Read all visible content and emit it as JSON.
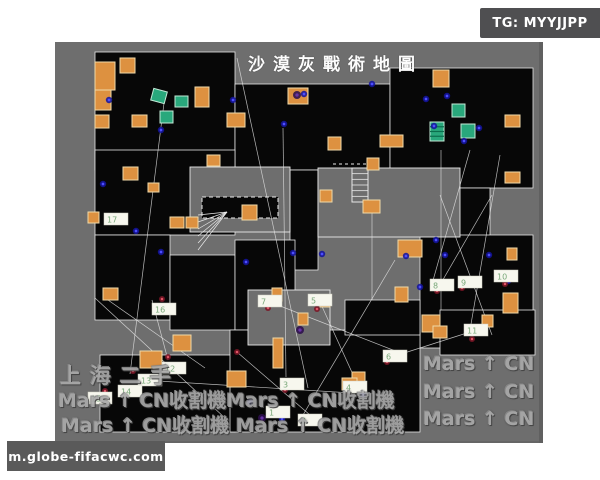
{
  "badges": {
    "tg": "TG: MYYJJPP",
    "site": "m.globe-fifacwc.com"
  },
  "watermarks": {
    "shanghai": "上海二手",
    "row1": "Mars ↑ CN收割機Mars ↑ CN收割機",
    "row2": "Mars ↑ CN收割機 Mars ↑ CN收割機",
    "right": [
      "Mars ↑ CN",
      "Mars ↑ CN",
      "Mars ↑ CN"
    ]
  },
  "map": {
    "title": "沙漠灰戰術地圖",
    "colors": {
      "bg": "#6e6e6e",
      "room": "#070707",
      "outline": "#e8e8e8",
      "crate_orange": "#dd9140",
      "crate_orange_edge": "#f0d9a8",
      "crate_green": "#29a87c",
      "crate_green_edge": "#c2e9d6",
      "dot_blue": "#15159e",
      "dot_blue_core": "#4d4dff",
      "dot_red": "#7a1626",
      "dot_red_core": "#e05566",
      "dot_purple": "#2e0f4e",
      "dot_purple_core": "#6a34a8",
      "label_bg": "#f7f7ee",
      "label_text": "#79a879",
      "line": "#e6e6e6"
    },
    "rooms": [
      [
        40,
        10,
        140,
        118
      ],
      [
        180,
        42,
        155,
        86
      ],
      [
        335,
        26,
        143,
        120
      ],
      [
        235,
        128,
        28,
        100
      ],
      [
        40,
        108,
        140,
        85
      ],
      [
        40,
        193,
        75,
        85
      ],
      [
        115,
        213,
        65,
        75
      ],
      [
        180,
        198,
        60,
        90
      ],
      [
        375,
        146,
        60,
        52
      ],
      [
        365,
        193,
        113,
        113
      ],
      [
        45,
        313,
        135,
        77
      ],
      [
        175,
        288,
        190,
        102
      ],
      [
        290,
        258,
        75,
        35
      ],
      [
        385,
        268,
        95,
        45
      ]
    ],
    "islands": [
      [
        135,
        125,
        100,
        65
      ],
      [
        263,
        126,
        142,
        69
      ],
      [
        193,
        248,
        82,
        55
      ]
    ],
    "dashed_rect": [
      147,
      155,
      76,
      21
    ],
    "dash_line": [
      278,
      122,
      312,
      122
    ],
    "stairs_fan": [
      143,
      170,
      29,
      38
    ],
    "ladder": [
      297,
      126,
      16,
      34
    ],
    "lines": [
      [
        110,
        53,
        75,
        332
      ],
      [
        182,
        16,
        253,
        346
      ],
      [
        228,
        86,
        231,
        335
      ],
      [
        97,
        258,
        113,
        318
      ],
      [
        40,
        256,
        170,
        376
      ],
      [
        53,
        258,
        150,
        326
      ],
      [
        215,
        260,
        343,
        310
      ],
      [
        265,
        260,
        305,
        348
      ],
      [
        87,
        338,
        297,
        351
      ],
      [
        385,
        153,
        437,
        293
      ],
      [
        437,
        153,
        382,
        248
      ],
      [
        415,
        108,
        377,
        242
      ],
      [
        445,
        113,
        415,
        288
      ],
      [
        340,
        218,
        245,
        378
      ],
      [
        182,
        310,
        255,
        373
      ],
      [
        343,
        313,
        415,
        290
      ],
      [
        386,
        108,
        386,
        268
      ],
      [
        317,
        168,
        317,
        258
      ]
    ],
    "crates_orange": [
      [
        40,
        20,
        20,
        28
      ],
      [
        65,
        16,
        15,
        15
      ],
      [
        40,
        48,
        16,
        20
      ],
      [
        40,
        73,
        14,
        13
      ],
      [
        77,
        73,
        15,
        12
      ],
      [
        140,
        45,
        14,
        20
      ],
      [
        172,
        71,
        18,
        14
      ],
      [
        233,
        46,
        20,
        16
      ],
      [
        378,
        28,
        16,
        17
      ],
      [
        450,
        73,
        15,
        12
      ],
      [
        325,
        93,
        23,
        12
      ],
      [
        273,
        95,
        13,
        13
      ],
      [
        312,
        116,
        12,
        12
      ],
      [
        265,
        148,
        12,
        12
      ],
      [
        308,
        158,
        17,
        13
      ],
      [
        450,
        130,
        15,
        11
      ],
      [
        68,
        125,
        15,
        13
      ],
      [
        93,
        141,
        11,
        9
      ],
      [
        152,
        113,
        13,
        11
      ],
      [
        187,
        163,
        15,
        15
      ],
      [
        115,
        175,
        14,
        11
      ],
      [
        131,
        175,
        12,
        11
      ],
      [
        33,
        170,
        11,
        11
      ],
      [
        48,
        246,
        15,
        12
      ],
      [
        217,
        246,
        10,
        13
      ],
      [
        243,
        271,
        10,
        12
      ],
      [
        218,
        296,
        10,
        30
      ],
      [
        118,
        293,
        18,
        16
      ],
      [
        85,
        309,
        22,
        17
      ],
      [
        172,
        329,
        19,
        16
      ],
      [
        343,
        198,
        24,
        17
      ],
      [
        452,
        206,
        10,
        12
      ],
      [
        340,
        245,
        13,
        15
      ],
      [
        265,
        253,
        10,
        12
      ],
      [
        367,
        273,
        18,
        17
      ],
      [
        448,
        251,
        15,
        20
      ],
      [
        427,
        273,
        11,
        12
      ],
      [
        297,
        330,
        13,
        11
      ],
      [
        287,
        336,
        15,
        12
      ],
      [
        378,
        284,
        14,
        12
      ]
    ],
    "crates_green": [
      {
        "x": 97,
        "y": 48,
        "w": 14,
        "h": 12,
        "rot": 15,
        "striped": false
      },
      {
        "x": 120,
        "y": 54,
        "w": 13,
        "h": 11,
        "rot": 0,
        "striped": false
      },
      {
        "x": 105,
        "y": 69,
        "w": 13,
        "h": 12,
        "rot": 0,
        "striped": false
      },
      {
        "x": 397,
        "y": 62,
        "w": 13,
        "h": 13,
        "rot": 0,
        "striped": false
      },
      {
        "x": 375,
        "y": 80,
        "w": 14,
        "h": 19,
        "rot": 0,
        "striped": true
      },
      {
        "x": 406,
        "y": 82,
        "w": 14,
        "h": 14,
        "rot": 0,
        "striped": false
      }
    ],
    "dots_blue": [
      [
        54,
        58
      ],
      [
        106,
        88
      ],
      [
        178,
        58
      ],
      [
        229,
        82
      ],
      [
        249,
        52
      ],
      [
        317,
        42
      ],
      [
        371,
        57
      ],
      [
        379,
        84
      ],
      [
        392,
        54
      ],
      [
        409,
        99
      ],
      [
        424,
        86
      ],
      [
        48,
        142
      ],
      [
        81,
        189
      ],
      [
        106,
        210
      ],
      [
        191,
        220
      ],
      [
        238,
        211
      ],
      [
        267,
        212
      ],
      [
        351,
        214
      ],
      [
        365,
        245
      ],
      [
        434,
        213
      ],
      [
        453,
        239
      ],
      [
        308,
        352
      ],
      [
        195,
        360
      ],
      [
        227,
        377
      ],
      [
        381,
        198
      ],
      [
        390,
        213
      ]
    ],
    "dots_red": [
      [
        107,
        257
      ],
      [
        78,
        329
      ],
      [
        92,
        340
      ],
      [
        50,
        349
      ],
      [
        113,
        315
      ],
      [
        182,
        310
      ],
      [
        213,
        266
      ],
      [
        262,
        267
      ],
      [
        382,
        249
      ],
      [
        407,
        246
      ],
      [
        332,
        320
      ],
      [
        292,
        349
      ],
      [
        230,
        348
      ],
      [
        248,
        382
      ],
      [
        417,
        297
      ],
      [
        450,
        242
      ]
    ],
    "dots_purple": [
      [
        242,
        53
      ],
      [
        207,
        376
      ],
      [
        245,
        288
      ]
    ],
    "markers": [
      {
        "n": "1",
        "x": 211,
        "y": 364
      },
      {
        "n": "2",
        "x": 243,
        "y": 372
      },
      {
        "n": "3",
        "x": 225,
        "y": 336
      },
      {
        "n": "4",
        "x": 288,
        "y": 339
      },
      {
        "n": "5",
        "x": 253,
        "y": 252
      },
      {
        "n": "6",
        "x": 328,
        "y": 308
      },
      {
        "n": "7",
        "x": 203,
        "y": 253
      },
      {
        "n": "8",
        "x": 375,
        "y": 237
      },
      {
        "n": "9",
        "x": 403,
        "y": 234
      },
      {
        "n": "10",
        "x": 439,
        "y": 228
      },
      {
        "n": "11",
        "x": 409,
        "y": 282
      },
      {
        "n": "12",
        "x": 107,
        "y": 320
      },
      {
        "n": "13",
        "x": 83,
        "y": 332
      },
      {
        "n": "14",
        "x": 63,
        "y": 343
      },
      {
        "n": "15",
        "x": 33,
        "y": 350
      },
      {
        "n": "16",
        "x": 97,
        "y": 261
      },
      {
        "n": "17",
        "x": 49,
        "y": 171
      }
    ]
  }
}
